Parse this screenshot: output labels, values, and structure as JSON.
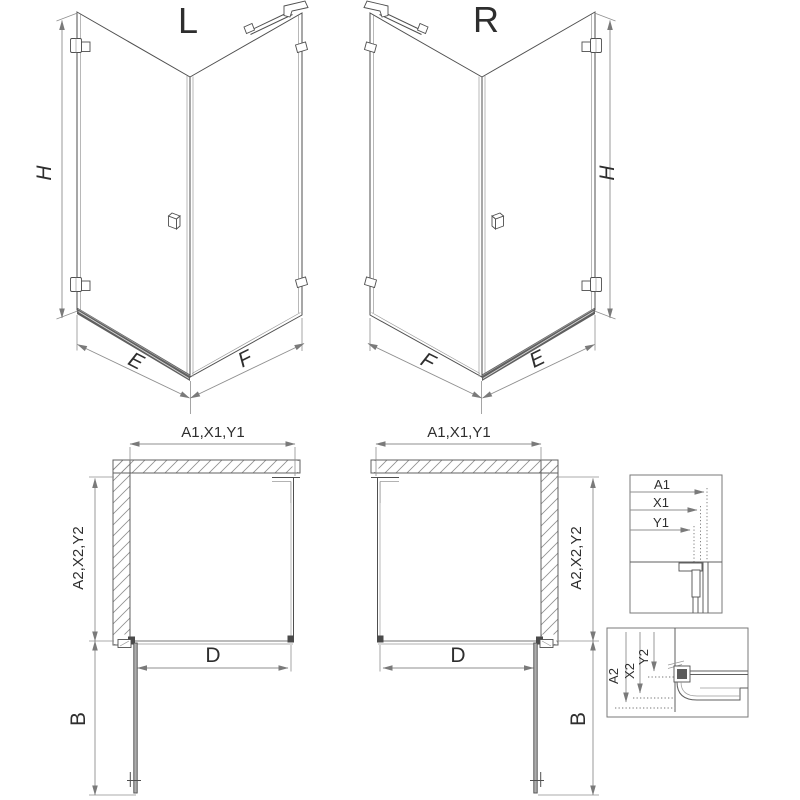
{
  "drawing": {
    "variant_left": "L",
    "variant_right": "R",
    "dim_height": "H",
    "dim_door_width": "E",
    "dim_side_width": "F",
    "dim_plan_width": "A1,X1,Y1",
    "dim_plan_depth": "A2,X2,Y2",
    "dim_door_opening": "D",
    "dim_door_swing": "B"
  },
  "detail_width": {
    "a1": "A1",
    "x1": "X1",
    "y1": "Y1"
  },
  "detail_depth": {
    "a2": "A2",
    "x2": "X2",
    "y2": "Y2"
  },
  "colors": {
    "background": "#ffffff",
    "line": "#4f4f4f",
    "glass_inner": "#9a9a9a",
    "dimension": "#8f8f8f",
    "hatch": "#8f8f8f",
    "text": "#2e2e2e",
    "rail": "#5f5f5f",
    "door_fill": "#adadad"
  }
}
